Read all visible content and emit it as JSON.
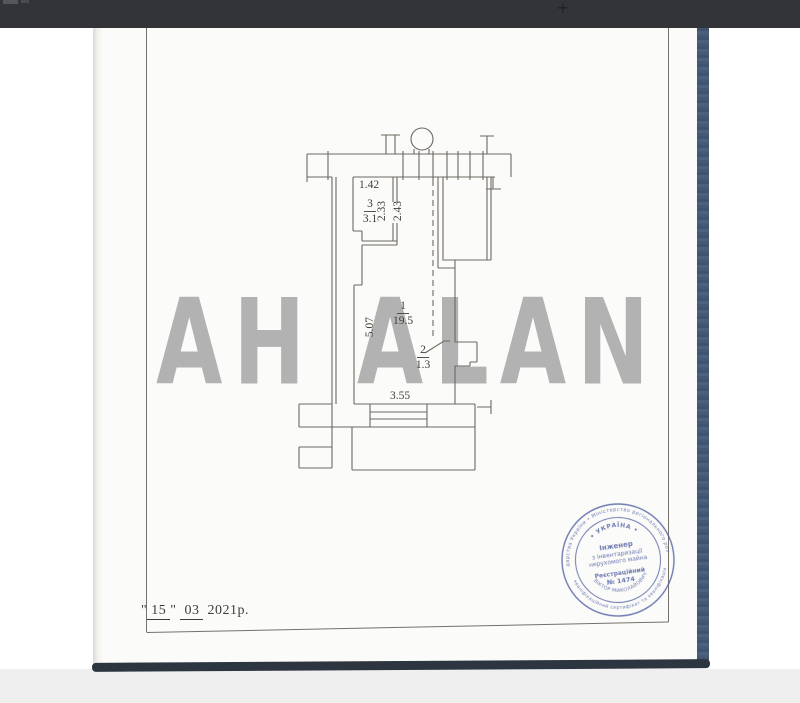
{
  "top_bar": {
    "zoom_plus": "+"
  },
  "watermark": {
    "text": "АН ALAN"
  },
  "plan": {
    "rooms": [
      {
        "number": "1",
        "area": "19.5"
      },
      {
        "number": "2",
        "area": "1.3"
      },
      {
        "number": "3",
        "area": "3.1"
      }
    ],
    "dimensions": {
      "room3_width": "1.42",
      "room3_left_depth": "2.33",
      "room3_right_depth": "2.43",
      "room1_height": "5.07",
      "room1_width": "3.55"
    }
  },
  "date": {
    "open_quote": "\"",
    "day": "15",
    "close_quote": "\"",
    "month": "03",
    "year": "2021р."
  },
  "stamp": {
    "ring_outer_top": "господарства України  •  Міністерство регіонального розвитку",
    "ring_outer_bottom": "кваліфікаційний сертифікат та кваліфікація",
    "ring_inner_top": "•  УКРАЇНА  •",
    "name_arc": "ВІКТОР МИКОЛАЙОВИЧ",
    "title_line1": "Інженер",
    "title_line2": "з інвентаризації",
    "title_line3": "нерухомого майна",
    "reg_label": "Реєстраційний",
    "reg_number": "№ 1474"
  },
  "colors": {
    "top_bar": "#333437",
    "stamp_blue": "#4a5aa0",
    "watermark_gray": "#a6a6a6",
    "book_edge_blue": "#475a76",
    "shadow_band": "#2c3540"
  }
}
